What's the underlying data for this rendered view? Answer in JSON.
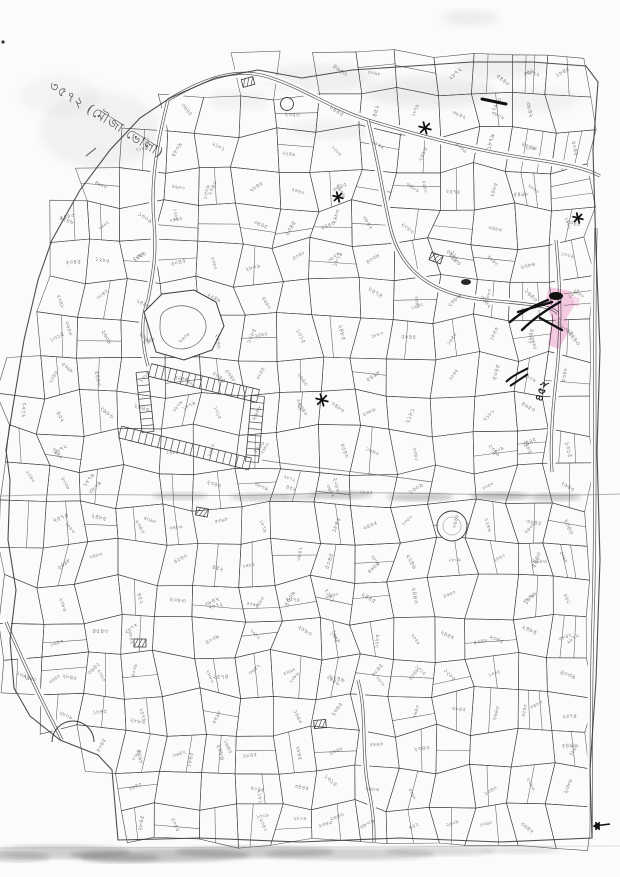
{
  "document": {
    "paper_color": "#fbfbfa",
    "ink_color": "#3b3b3b",
    "highlight_color": "#f29ed0",
    "title_annotation": {
      "text": "৩৫৭২ (মৌজা ভোলা)"
    },
    "bold_plot_label": "৪৫২",
    "pink_parcel_label": "২২৮৮",
    "parcel_numbers": [
      "২১৮১",
      "২৩৪০",
      "১৩০৯",
      "২৩৫৩",
      "২২৪৬",
      "২৪৪৩",
      "২৩৪৫",
      "৫৩৪৮",
      "১৩১৫",
      "২৬৪৩",
      "২৩৪৩",
      "৫৩৯৮",
      "৪৫২",
      "২৮৭২",
      "৩৮৪২",
      "৪০৩৯",
      "২৫৭৪",
      "২৮৮৩",
      "৫৪৯৮",
      "২৩৮৬",
      "১৬৪৩",
      "২৮৪৫",
      "৩৪৪৫",
      "২৮০৯",
      "৪৬৫৩",
      "২৪৪৫",
      "১২৮৫",
      "৩০৪৫",
      "২৬০৮",
      "৫৪৪৩",
      "২৯৮৩",
      "৩৮০৯",
      "১৮৭৯",
      "২৪৮৫",
      "৩৪৮৩",
      "৪৫৪৩",
      "২০৮৩",
      "৩৬৪২",
      "১৮৪৫",
      "৫০৪৫"
    ]
  }
}
